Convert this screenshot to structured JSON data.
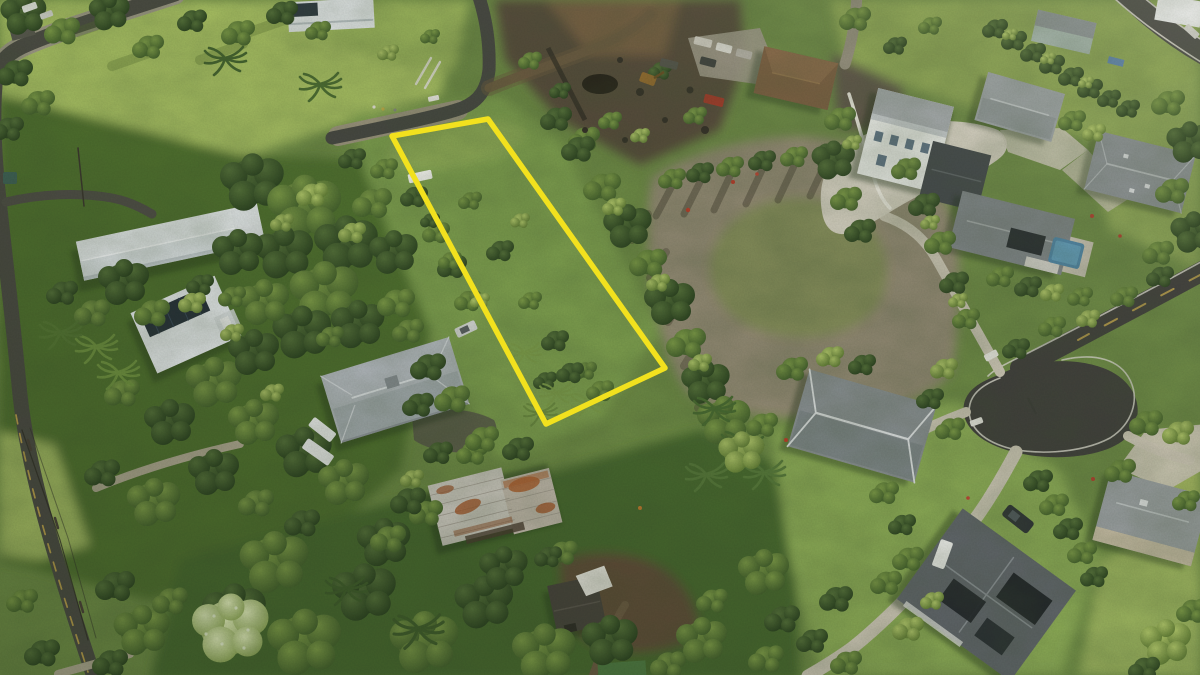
{
  "scene": {
    "type": "aerial-drone-photograph",
    "description": "Oblique aerial photo of a lush tropical residential neighborhood; a long narrow vacant overgrown lot in the center-left is outlined in bright yellow. Newer subdivision homes with gray roofs, white concrete driveways and a cul-de-sac occupy the right; older homes with white and rusted metal roofs sit among dense trees on the left; a graded bare-dirt lot and dark lava-rock clearing span the upper middle.",
    "width_px": 1200,
    "height_px": 675
  },
  "property_outline": {
    "label": "highlighted lot boundary",
    "color": "#F2E11E",
    "stroke_width": 5.5,
    "points": "392,136 488,119 665,368 546,424"
  },
  "palette": {
    "canopy_dark": "#3F5A2B",
    "canopy_mid": "#5F7F39",
    "lawn_bright": "#A9C164",
    "scrub_lot": "#7FA050",
    "dirt_lot": "#948B75",
    "lava_rock": "#564C3B",
    "asphalt": "#474743",
    "concrete": "#CDC7B6",
    "roof_gray": "#8A9093",
    "roof_white": "#E9EDEF",
    "road_paint_yellow": "#C9A94E",
    "road_paint_white": "#DBD8CE",
    "pool_blue": "#4F86A8"
  },
  "landmarks": [
    {
      "id": "highlighted-lot",
      "label": "vacant overgrown lot outlined in yellow",
      "center": [
        520,
        270
      ]
    },
    {
      "id": "access-road-top",
      "label": "paved road along top edge of outlined lot",
      "center": [
        420,
        112
      ]
    },
    {
      "id": "left-road",
      "label": "tree-lined road with dashed yellow centerline and power lines, lower left",
      "center": [
        55,
        540
      ]
    },
    {
      "id": "main-road",
      "label": "main subdivision road ending in cul-de-sac bulb, right side",
      "center": [
        1090,
        350
      ]
    },
    {
      "id": "cul-de-sac",
      "label": "teardrop turnaround with white edge striping",
      "center": [
        1050,
        410
      ]
    },
    {
      "id": "cleared-dirt-lot",
      "label": "graded bare dirt lot with mossy green patch",
      "center": [
        800,
        280
      ]
    },
    {
      "id": "lava-rock-clearing",
      "label": "dark lava rock / excavated clearing",
      "center": [
        615,
        80
      ]
    },
    {
      "id": "house-long-white-roof",
      "label": "long white-roofed house, left",
      "center": [
        170,
        240
      ]
    },
    {
      "id": "house-white-solar",
      "label": "white-roofed house with solar array, left",
      "center": [
        185,
        325
      ]
    },
    {
      "id": "house-metal-roof",
      "label": "gray metal hip-roof house with cupola",
      "center": [
        395,
        390
      ]
    },
    {
      "id": "house-rusty-roof",
      "label": "rusted corrugated metal roof house, bottom center",
      "center": [
        496,
        505
      ]
    },
    {
      "id": "shed-dark",
      "label": "dark shed with white tarp",
      "center": [
        578,
        605
      ]
    },
    {
      "id": "house-brown-roof",
      "label": "brown hip-roof house with parked trucks, top center",
      "center": [
        795,
        78
      ]
    },
    {
      "id": "house-white-two-story",
      "label": "large white two-story house with concrete drive, upper right",
      "center": [
        920,
        150
      ]
    },
    {
      "id": "house-gray-roof-a",
      "label": "gray-roof house, top right",
      "center": [
        1020,
        106
      ]
    },
    {
      "id": "house-gray-roof-b",
      "label": "large gray-roof house, right edge",
      "center": [
        1140,
        172
      ]
    },
    {
      "id": "house-pool",
      "label": "gray-roof house with swimming pool",
      "center": [
        1012,
        232
      ]
    },
    {
      "id": "swimming-pool",
      "label": "blue swimming pool",
      "center": [
        1066,
        254
      ]
    },
    {
      "id": "house-gray-br",
      "label": "gray hip-roof house with white ridge caps, lower right",
      "center": [
        862,
        426
      ]
    },
    {
      "id": "house-solar-br",
      "label": "large dark roof house with solar panels, bottom right",
      "center": [
        985,
        595
      ]
    },
    {
      "id": "house-right-edge",
      "label": "gray-roof tan house, bottom right edge",
      "center": [
        1150,
        518
      ]
    },
    {
      "id": "house-top-left-edge",
      "label": "white-roofed house at top edge with solar panels",
      "center": [
        330,
        14
      ]
    },
    {
      "id": "vehicles",
      "label": "assorted parked cars, pickup trucks and an excavator",
      "center": [
        700,
        60
      ]
    },
    {
      "id": "power-lines",
      "label": "utility poles and wires along lower-left road",
      "center": [
        55,
        520
      ]
    }
  ]
}
